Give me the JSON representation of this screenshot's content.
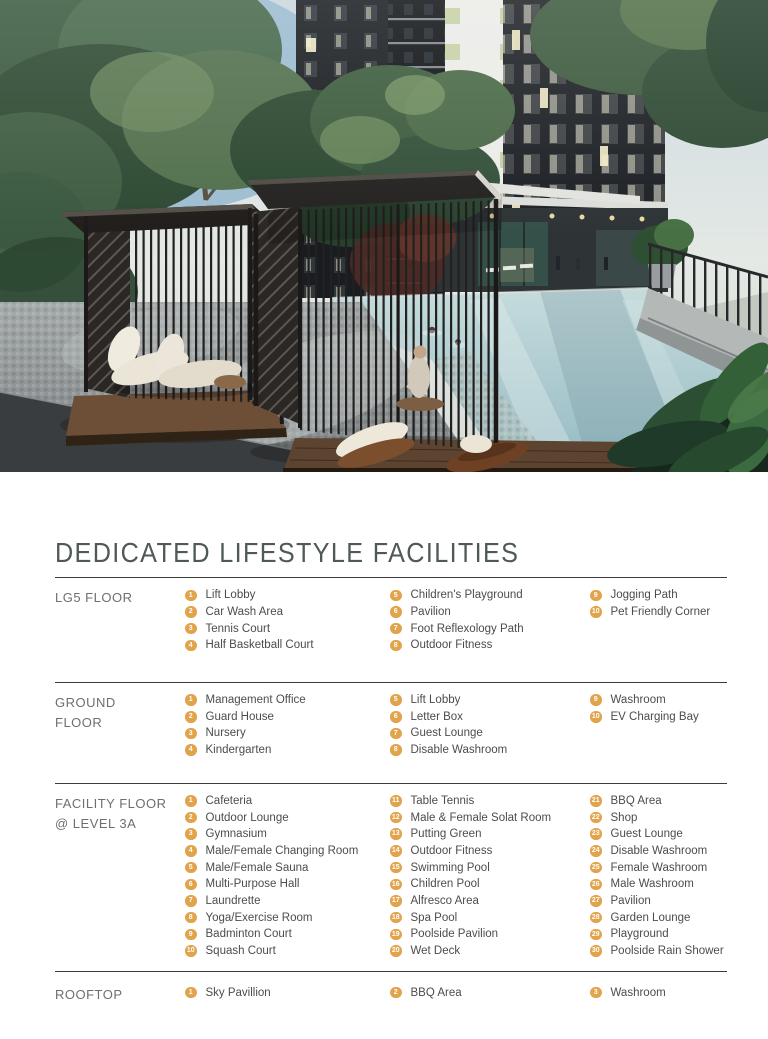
{
  "title": "DEDICATED LIFESTYLE FACILITIES",
  "colors": {
    "accent": "#e1a44c",
    "title": "#4f5a55",
    "floor_label": "#6c706e",
    "body_text": "#4c4c4c",
    "rule": "#3c3c3c"
  },
  "sections": [
    {
      "id": "lg5",
      "label": "LG5 FLOOR",
      "columns": [
        [
          {
            "n": "1",
            "t": "Lift Lobby"
          },
          {
            "n": "2",
            "t": "Car Wash Area"
          },
          {
            "n": "3",
            "t": "Tennis Court"
          },
          {
            "n": "4",
            "t": "Half Basketball Court"
          }
        ],
        [
          {
            "n": "5",
            "t": "Children's Playground"
          },
          {
            "n": "6",
            "t": "Pavilion"
          },
          {
            "n": "7",
            "t": "Foot Reflexology Path"
          },
          {
            "n": "8",
            "t": "Outdoor Fitness"
          }
        ],
        [
          {
            "n": "9",
            "t": "Jogging Path"
          },
          {
            "n": "10",
            "t": "Pet Friendly Corner"
          }
        ]
      ]
    },
    {
      "id": "ground",
      "label": "GROUND FLOOR",
      "columns": [
        [
          {
            "n": "1",
            "t": "Management Office"
          },
          {
            "n": "2",
            "t": "Guard House"
          },
          {
            "n": "3",
            "t": "Nursery"
          },
          {
            "n": "4",
            "t": "Kindergarten"
          }
        ],
        [
          {
            "n": "5",
            "t": "Lift Lobby"
          },
          {
            "n": "6",
            "t": "Letter Box"
          },
          {
            "n": "7",
            "t": "Guest Lounge"
          },
          {
            "n": "8",
            "t": "Disable Washroom"
          }
        ],
        [
          {
            "n": "9",
            "t": "Washroom"
          },
          {
            "n": "10",
            "t": "EV Charging Bay"
          }
        ]
      ]
    },
    {
      "id": "level3a",
      "label": "FACILITY FLOOR",
      "label2": "@ LEVEL 3A",
      "columns": [
        [
          {
            "n": "1",
            "t": "Cafeteria"
          },
          {
            "n": "2",
            "t": "Outdoor Lounge"
          },
          {
            "n": "3",
            "t": "Gymnasium"
          },
          {
            "n": "4",
            "t": "Male/Female Changing Room"
          },
          {
            "n": "5",
            "t": "Male/Female Sauna"
          },
          {
            "n": "6",
            "t": "Multi-Purpose Hall"
          },
          {
            "n": "7",
            "t": "Laundrette"
          },
          {
            "n": "8",
            "t": "Yoga/Exercise Room"
          },
          {
            "n": "9",
            "t": "Badminton Court"
          },
          {
            "n": "10",
            "t": "Squash Court"
          }
        ],
        [
          {
            "n": "11",
            "t": "Table Tennis"
          },
          {
            "n": "12",
            "t": "Male & Female Solat Room"
          },
          {
            "n": "13",
            "t": "Putting Green"
          },
          {
            "n": "14",
            "t": "Outdoor Fitness"
          },
          {
            "n": "15",
            "t": "Swimming Pool"
          },
          {
            "n": "16",
            "t": "Children Pool"
          },
          {
            "n": "17",
            "t": "Alfresco Area"
          },
          {
            "n": "18",
            "t": "Spa Pool"
          },
          {
            "n": "19",
            "t": "Poolside Pavilion"
          },
          {
            "n": "20",
            "t": "Wet Deck"
          }
        ],
        [
          {
            "n": "21",
            "t": "BBQ Area"
          },
          {
            "n": "22",
            "t": "Shop"
          },
          {
            "n": "23",
            "t": "Guest Lounge"
          },
          {
            "n": "24",
            "t": "Disable Washroom"
          },
          {
            "n": "25",
            "t": "Female Washroom"
          },
          {
            "n": "26",
            "t": "Male Washroom"
          },
          {
            "n": "27",
            "t": "Pavilion"
          },
          {
            "n": "28",
            "t": "Garden Lounge"
          },
          {
            "n": "29",
            "t": "Playground"
          },
          {
            "n": "30",
            "t": "Poolside Rain Shower"
          }
        ]
      ]
    },
    {
      "id": "rooftop",
      "label": "ROOFTOP",
      "columns": [
        [
          {
            "n": "1",
            "t": "Sky Pavillion"
          }
        ],
        [
          {
            "n": "2",
            "t": "BBQ Area"
          }
        ],
        [
          {
            "n": "3",
            "t": "Washroom"
          }
        ]
      ]
    }
  ]
}
